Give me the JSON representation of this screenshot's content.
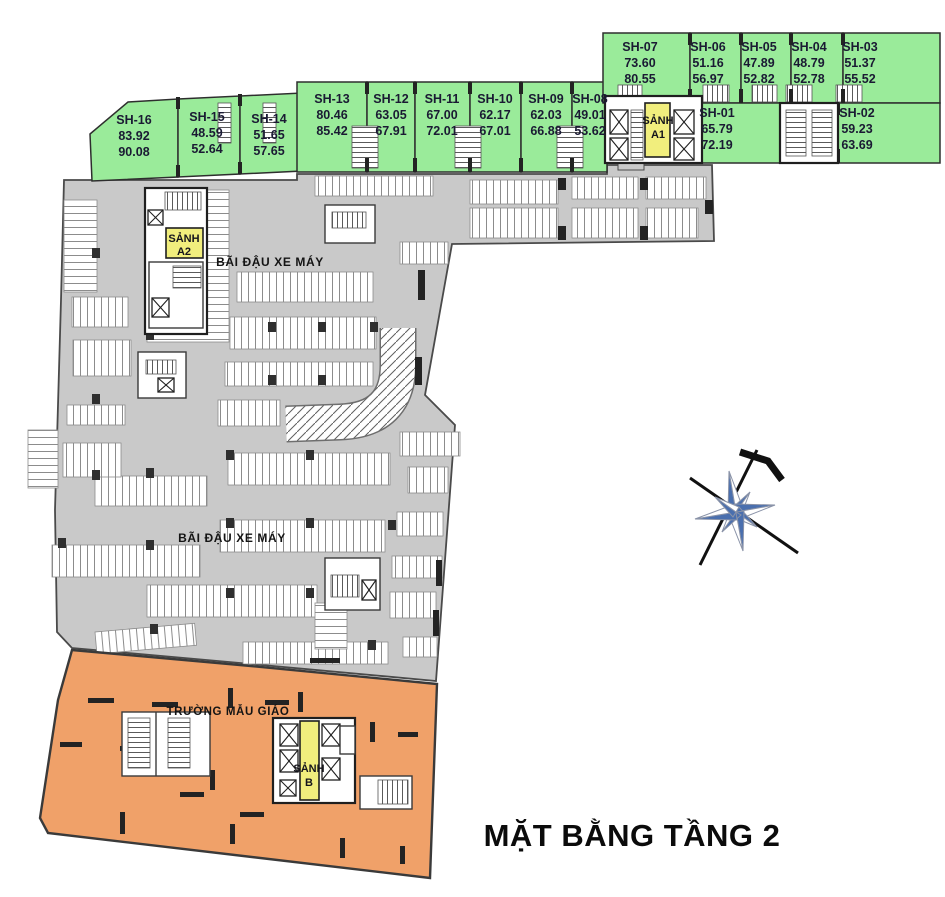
{
  "title": "MẶT BẰNG TẦNG 2",
  "labels": {
    "parking_upper": "BÃI ĐẬU XE MÁY",
    "parking_lower": "BÃI ĐẬU XE MÁY",
    "kindergarten": "TRƯỜNG MẪU GIÁO"
  },
  "lobbies": {
    "a1": {
      "line1": "SẢNH",
      "line2": "A1"
    },
    "a2": {
      "line1": "SẢNH",
      "line2": "A2"
    },
    "b": {
      "line1": "SẢNH",
      "line2": "B"
    }
  },
  "units": {
    "sh01": {
      "name": "SH-01",
      "area1": "65.79",
      "area2": "72.19"
    },
    "sh02": {
      "name": "SH-02",
      "area1": "59.23",
      "area2": "63.69"
    },
    "sh03": {
      "name": "SH-03",
      "area1": "51.37",
      "area2": "55.52"
    },
    "sh04": {
      "name": "SH-04",
      "area1": "48.79",
      "area2": "52.78"
    },
    "sh05": {
      "name": "SH-05",
      "area1": "47.89",
      "area2": "52.82"
    },
    "sh06": {
      "name": "SH-06",
      "area1": "51.16",
      "area2": "56.97"
    },
    "sh07": {
      "name": "SH-07",
      "area1": "73.60",
      "area2": "80.55"
    },
    "sh08": {
      "name": "SH-08",
      "area1": "49.01",
      "area2": "53.62"
    },
    "sh09": {
      "name": "SH-09",
      "area1": "62.03",
      "area2": "66.88"
    },
    "sh10": {
      "name": "SH-10",
      "area1": "62.17",
      "area2": "67.01"
    },
    "sh11": {
      "name": "SH-11",
      "area1": "67.00",
      "area2": "72.01"
    },
    "sh12": {
      "name": "SH-12",
      "area1": "63.05",
      "area2": "67.91"
    },
    "sh13": {
      "name": "SH-13",
      "area1": "80.46",
      "area2": "85.42"
    },
    "sh14": {
      "name": "SH-14",
      "area1": "51.65",
      "area2": "57.65"
    },
    "sh15": {
      "name": "SH-15",
      "area1": "48.59",
      "area2": "52.64"
    },
    "sh16": {
      "name": "SH-16",
      "area1": "83.92",
      "area2": "90.08"
    }
  },
  "colors": {
    "unit_green": "#9aeb9a",
    "parking_gray": "#c9c9c9",
    "kindergarten_orange": "#f0a169",
    "lobby_yellow": "#f1ee7d",
    "compass_blue": "#4a6fae",
    "wall_dark": "#2b2b2b",
    "label_navy": "#1a1a33"
  }
}
